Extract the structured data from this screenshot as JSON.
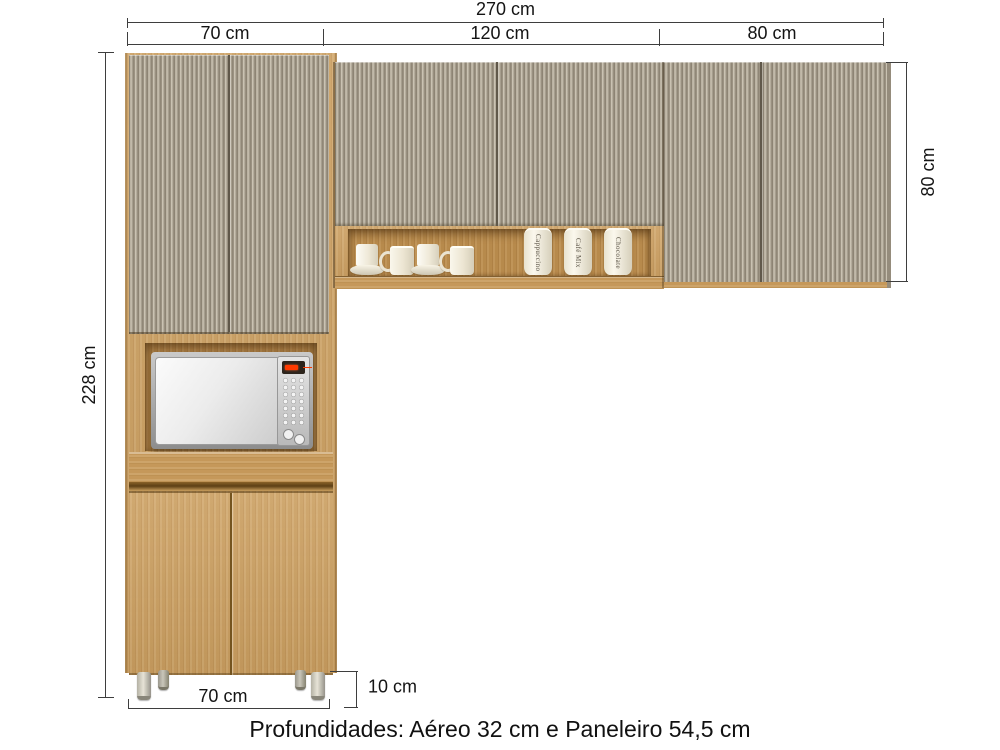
{
  "page": {
    "caption": "Profundidades: Aéreo 32 cm e Paneleiro 54,5 cm"
  },
  "dimensions": {
    "total_width": "270 cm",
    "segment_left": "70 cm",
    "segment_middle": "120 cm",
    "segment_right": "80 cm",
    "total_height": "228 cm",
    "upper_height": "80 cm",
    "base_width": "70 cm",
    "feet_height": "10 cm"
  },
  "furniture": {
    "canisters": [
      "Cappuccino",
      "Café Mix",
      "Chocolate"
    ],
    "colors": {
      "wood": "#cfa263",
      "wood_dark": "#bd8f50",
      "flute_base": "#b2aa9a",
      "flute_dark": "#8d8474",
      "flute_light": "#cfc8b8",
      "dimension_line": "#3e3e3e",
      "text": "#141414",
      "background": "#ffffff"
    }
  }
}
